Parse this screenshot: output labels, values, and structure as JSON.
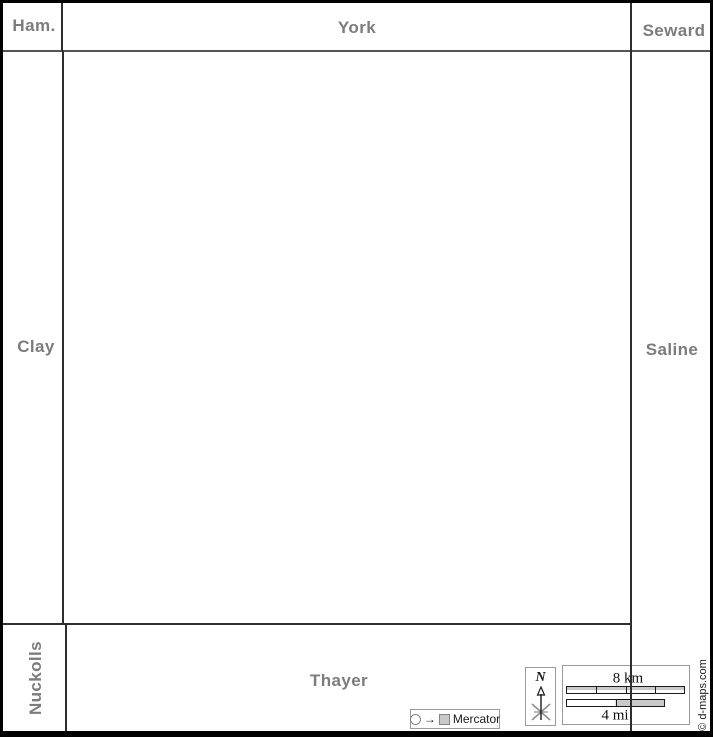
{
  "map": {
    "neighbors": {
      "hamilton": "Ham.",
      "york": "York",
      "seward": "Seward",
      "clay": "Clay",
      "saline": "Saline",
      "nuckolls": "Nuckolls",
      "thayer": "Thayer"
    },
    "label_color": "#7c7c7c",
    "border_color": "#2e2e2e",
    "background_color": "#ffffff"
  },
  "legend": {
    "projection": {
      "label": "Mercator",
      "arrow_glyph": "→"
    },
    "compass": {
      "north_label": "N"
    },
    "scale": {
      "km_label": "8 km",
      "mi_label": "4 mi"
    },
    "credit": "© d-maps.com"
  }
}
